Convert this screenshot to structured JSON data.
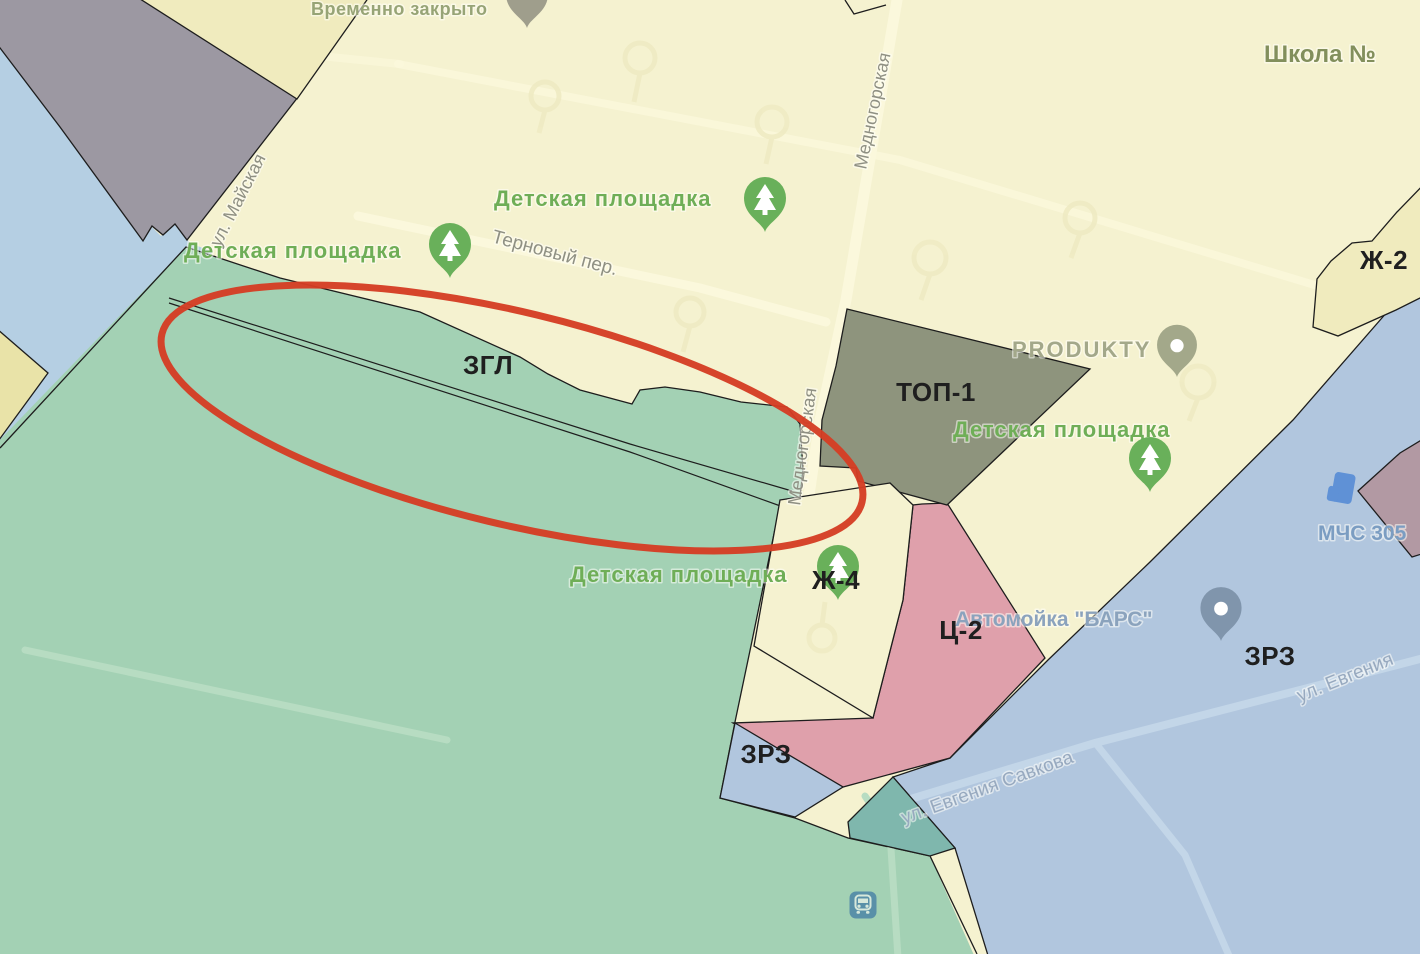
{
  "colors": {
    "base_yellow": "#f5f2d0",
    "road_cream": "#fbf8dc",
    "driveway_cream": "#efebc3",
    "zone_yellow_dark": "#f0ebbe",
    "wedge_yellow": "#e9e3a8",
    "zone_green": "#a3d1b4",
    "zone_green_road": "#b7dcc2",
    "zone_teal_dark": "#7fb7ad",
    "zone_blue": "#b1c6de",
    "zone_blue_road": "#c3d6e8",
    "water_blue": "#b5cfe3",
    "zone_gray": "#9c98a2",
    "zone_olive": "#8e947d",
    "zone_pink": "#dfa0ab",
    "zone_mauve": "#b299a3",
    "boundary_black": "#1d1d1d",
    "annotation_red": "#d43d24",
    "label_black": "#1f1f1f",
    "poi_green": "#6fae57",
    "pin_green": "#69b05a",
    "poi_olive": "#97a476",
    "poi_olive_dark": "#828f5c",
    "pin_olive": "#a3a88a",
    "pin_gray": "#9f9e8c",
    "street_gray": "#8f9083",
    "poi_bluegray": "#8ba3bd",
    "pin_bluegray": "#8095ac",
    "poi_blue": "#7b9dc2",
    "street_bluegray": "#97a9bf",
    "mchs_icon_blue": "#5b8fd6",
    "transit_icon_blue": "#4f86a6"
  },
  "labels": {
    "temporarily_closed": "Временно закрыто",
    "school": "Школа №",
    "playground": "Детская площадка",
    "ternovy_lane": "Терновый пер.",
    "mednogorskaya": "Медногорская",
    "mayskaya": "ул. Майская",
    "produkty": "PRODUKTY",
    "carwash": "Автомойка \"БАРС\"",
    "mchs": "МЧС 305",
    "savkova": "ул. Евгения Савкова",
    "evgeniya": "ул. Евгения"
  },
  "zone_labels": {
    "zgl": "ЗГЛ",
    "top1": "ТОП-1",
    "zh2": "Ж-2",
    "zh4": "Ж-4",
    "c2": "Ц-2",
    "zrz": "ЗРЗ"
  },
  "icons": {
    "playground_pin": "tree-pin",
    "produkty_pin": "dot-poi-pin",
    "carwash_pin": "dot-poi-pin",
    "closed_poi_pin": "gray-pin",
    "mchs_building": "building-icon",
    "transit_station": "bus-station-icon",
    "annotation": "red-ellipse"
  }
}
